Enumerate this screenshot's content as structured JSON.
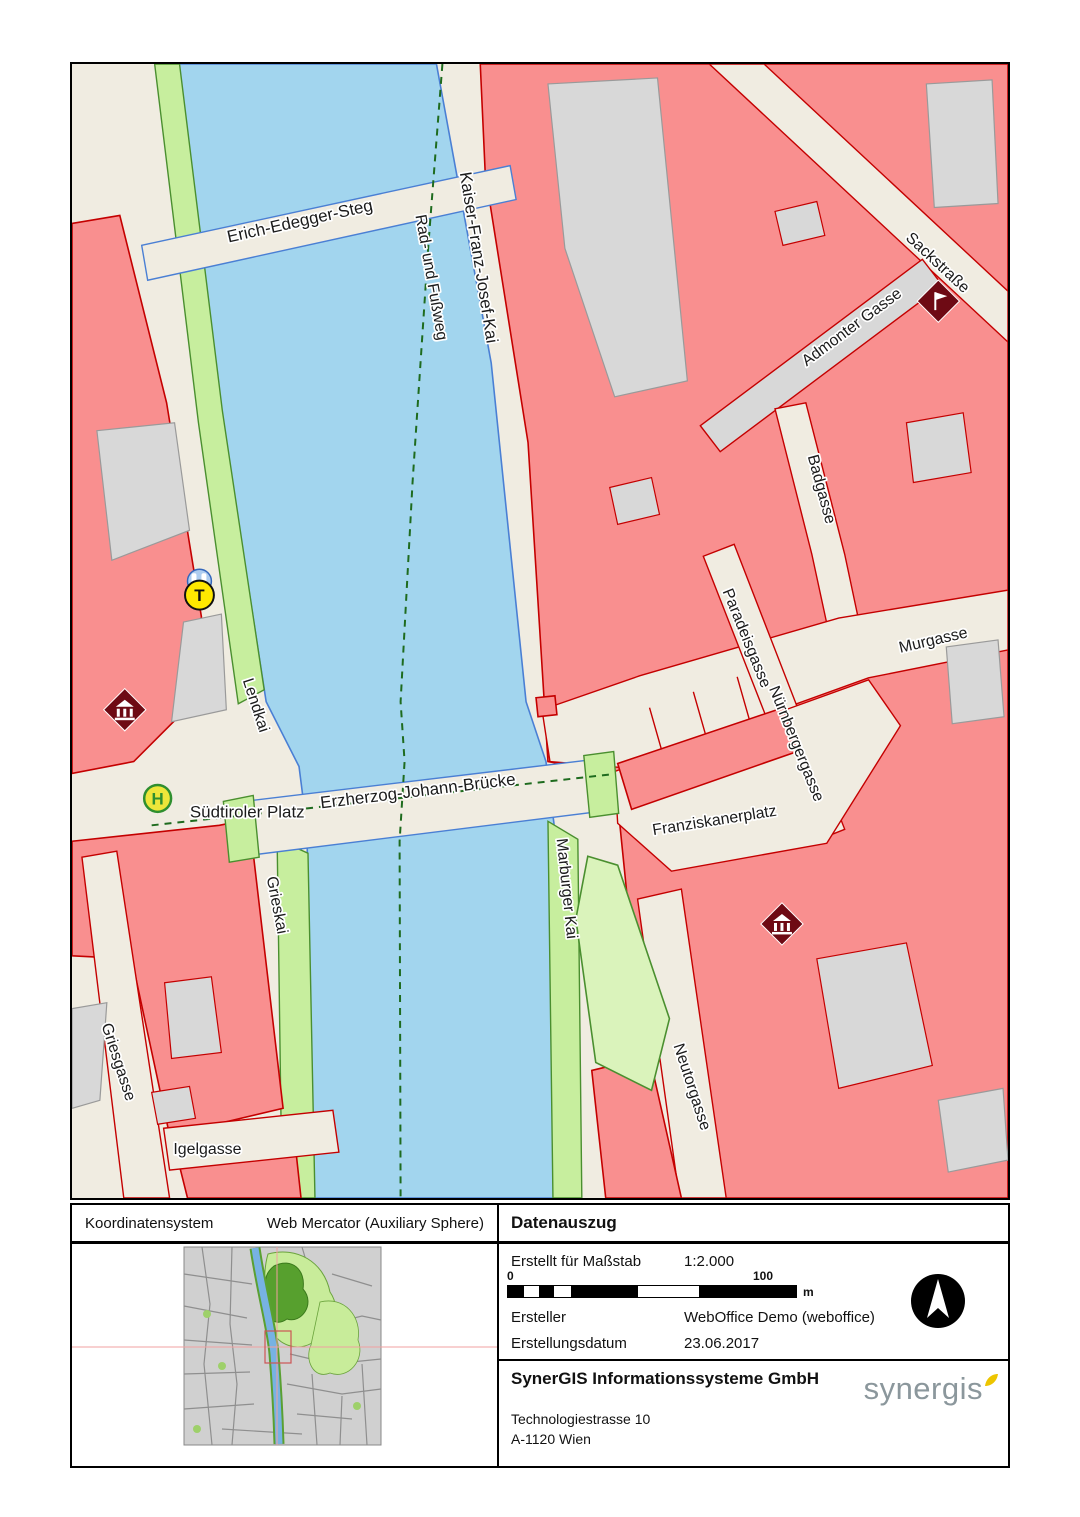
{
  "map": {
    "labels": {
      "erich": "Erich-Edegger-Steg",
      "kfj": "Kaiser-Franz-Josef-Kai",
      "rad": "Rad- und Fußweg",
      "sack": "Sackstraße",
      "admonter": "Admonter Gasse",
      "badgasse": "Badgasse",
      "paradeisgasse": "Paradeisgasse",
      "nuernbergergasse": "Nürnbergergasse",
      "murgasse": "Murgasse",
      "lendkai": "Lendkai",
      "suedtiroler": "Südtiroler Platz",
      "erzherzog": "Erzherzog-Johann-Brücke",
      "franziskanerplatz": "Franziskanerplatz",
      "marburger": "Marburger Kai",
      "grieskai": "Grieskai",
      "griesgasse": "Griesgasse",
      "igelgasse": "Igelgasse",
      "neutorgasse": "Neutorgasse"
    },
    "icons": {
      "tram_stop_letter": "T",
      "bus_stop_letter": "H"
    }
  },
  "panel": {
    "koordinatensystem_label": "Koordinatensystem",
    "koordinatensystem_value": "Web Mercator (Auxiliary Sphere)",
    "datenauszug_title": "Datenauszug",
    "massstab_label": "Erstellt für Maßstab",
    "massstab_value": "1:2.000",
    "scalebar_start": "0",
    "scalebar_end": "100",
    "scalebar_unit": "m",
    "ersteller_label": "Ersteller",
    "ersteller_value": "WebOffice Demo (weboffice)",
    "erstellungsdatum_label": "Erstellungsdatum",
    "erstellungsdatum_value": "23.06.2017",
    "company_name": "SynerGIS Informationssysteme GmbH",
    "address_line1": "Technologiestrasse 10",
    "address_line2": "A-1120 Wien",
    "logo_text": "synergis"
  },
  "colors": {
    "building": "#f98f8f",
    "building_border": "#c40000",
    "water": "#a2d5ee",
    "water_border": "#4a7fd4",
    "bank_green": "#c7ee9e",
    "bank_green_border": "#4a8f2f",
    "park": "#daf3bb",
    "street": "#f0ece1",
    "gray_building": "#d8d8d8",
    "poi": "#6e0a14",
    "accent_yellow": "#edc500",
    "dash_green": "#1e6b1e"
  }
}
